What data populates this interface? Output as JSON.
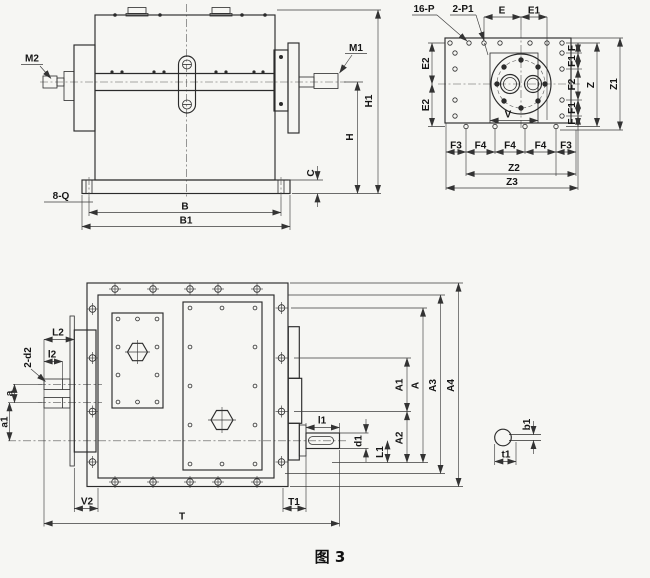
{
  "figure": {
    "caption": "图 3"
  },
  "labels": {
    "front": {
      "m2": "M2",
      "m1": "M1",
      "h1": "H1",
      "h": "H",
      "c": "C",
      "q_holes": "8-Q",
      "b": "B",
      "b1": "B1"
    },
    "face": {
      "p_holes": "16-P",
      "p1_holes": "2-P1",
      "e": "E",
      "e1": "E1",
      "e2_top": "E2",
      "e2_bottom": "E2",
      "f_top": "F",
      "f1_top": "F1",
      "f2": "F2",
      "f1_bottom": "F1",
      "f_bottom": "F",
      "z": "Z",
      "z1": "Z1",
      "v": "V",
      "f3_left": "F3",
      "f4_1": "F4",
      "f4_2": "F4",
      "f4_3": "F4",
      "f3_right": "F3",
      "z2": "Z2",
      "z3": "Z3"
    },
    "top": {
      "l2_big": "L2",
      "l2_small": "l2",
      "d2_holes": "2-d2",
      "a_small": "a",
      "a1_small": "a1",
      "v2": "V2",
      "t": "T",
      "t1": "T1",
      "l1_small": "l1",
      "d1": "d1",
      "l1_big": "L1",
      "a1_big": "A1",
      "a_big": "A",
      "a2_big": "A2",
      "a3_big": "A3",
      "a4_big": "A4"
    },
    "key": {
      "b1": "b1",
      "t1": "t1"
    }
  }
}
